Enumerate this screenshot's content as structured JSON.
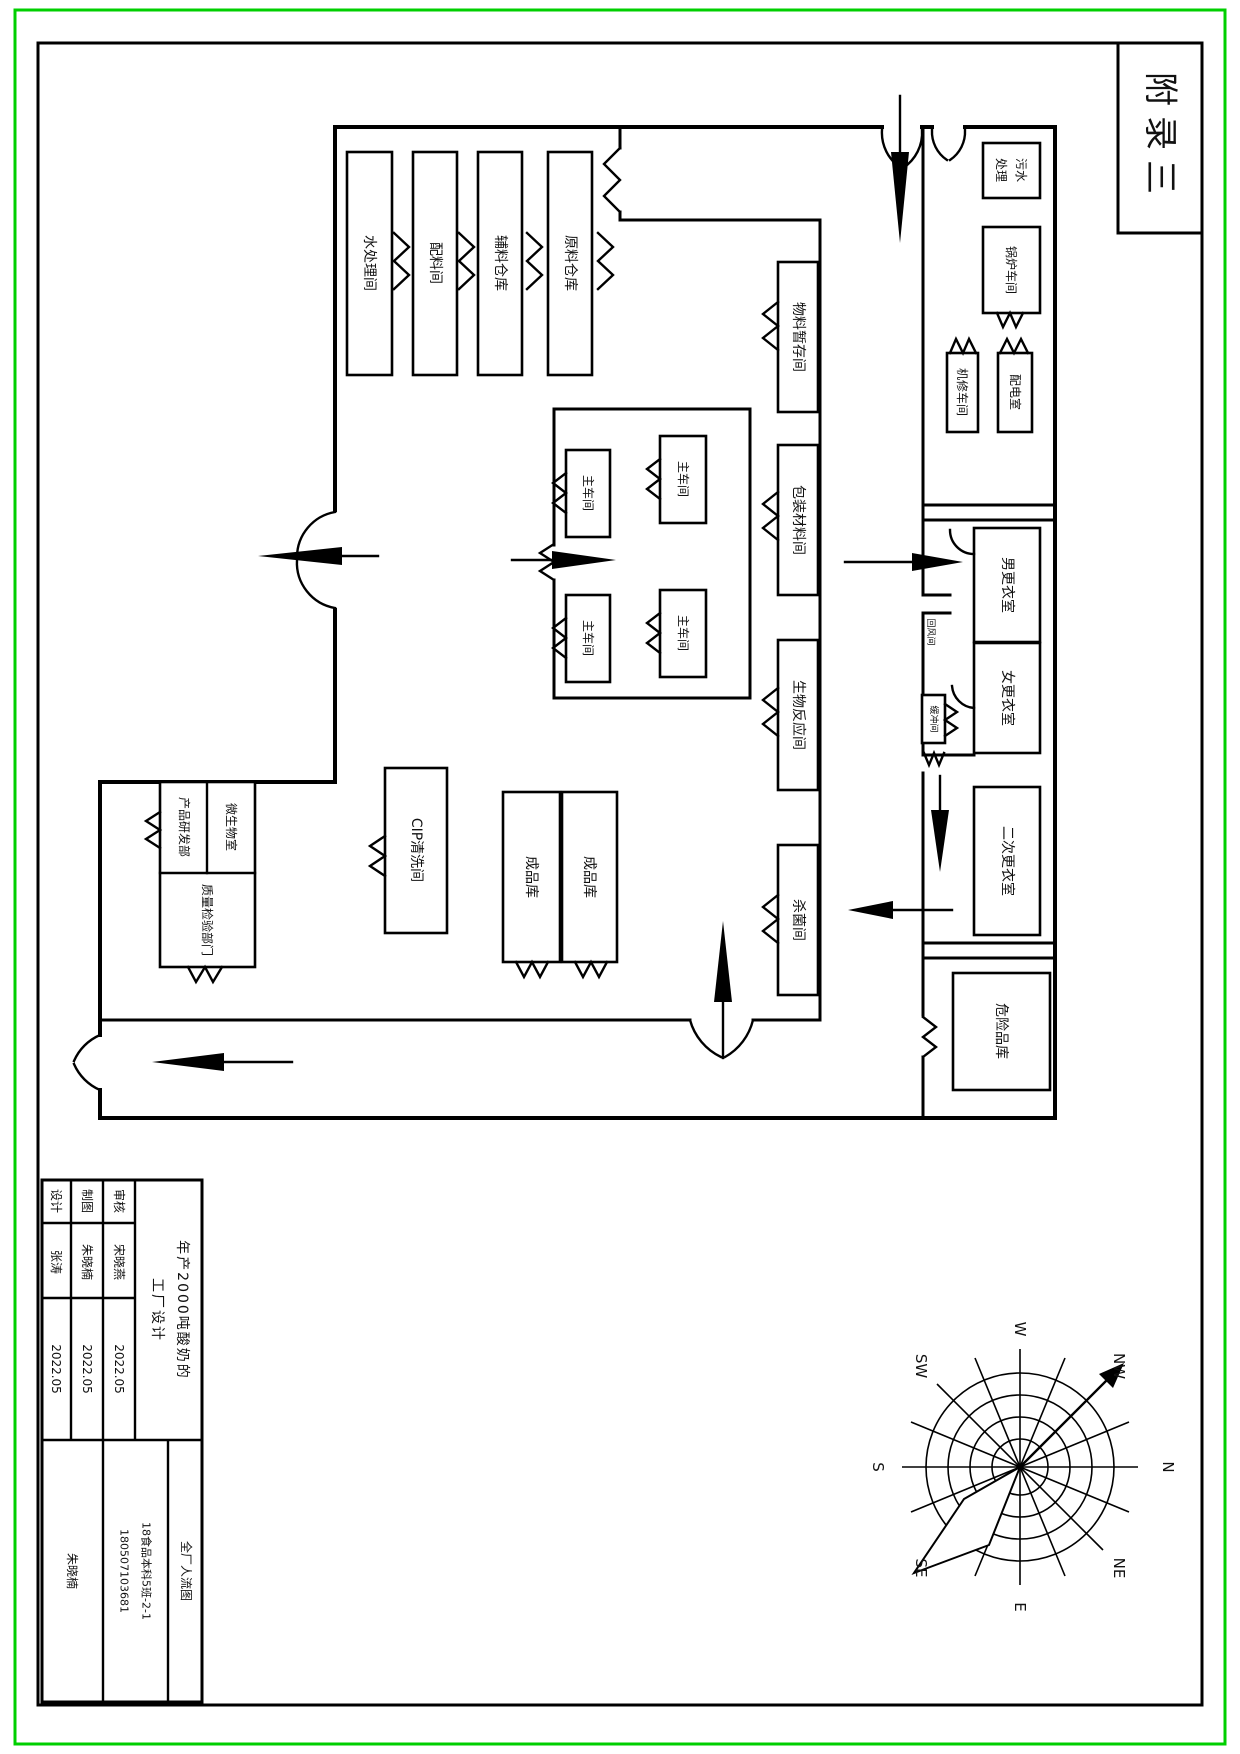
{
  "page": {
    "appendix_label": "附录三"
  },
  "rooms": {
    "water_treatment": "水处理间",
    "ingredient": "配料间",
    "aux_warehouse": "辅料仓库",
    "raw_warehouse": "原料仓库",
    "material_temp": "物料暂存间",
    "packaging": "包装材料间",
    "bio_reaction": "生物反应间",
    "sterilization": "杀菌间",
    "main_workshop": "主车间",
    "rnd": "产品研发部",
    "micro_lab": "微生物室",
    "qc": "质量检验部门",
    "cip": "CIP清洗间",
    "finished_goods": "成品库",
    "sewage_line1": "污水",
    "sewage_line2": "处理",
    "boiler": "锅炉车间",
    "machine_repair": "机修车间",
    "electrical": "配电室",
    "male_changing": "男更衣室",
    "female_changing": "女更衣室",
    "secondary_changing": "二次更衣室",
    "hazard_storage": "危险品库",
    "buffer": "缓冲间",
    "air_return": "回风间"
  },
  "title_block": {
    "rows": [
      {
        "label": "设计",
        "name": "张涛",
        "date": "2022.05"
      },
      {
        "label": "制图",
        "name": "朱晓楠",
        "date": "2022.05"
      },
      {
        "label": "审核",
        "name": "宋晓燕",
        "date": "2022.05"
      }
    ],
    "project_title_line1": "年产2000吨酸奶的",
    "project_title_line2": "工厂设计",
    "author": "朱晓楠",
    "class_info": "18食品本科5班-2-1",
    "student_id": "180507103681",
    "drawing_name": "全厂人流图"
  },
  "compass": {
    "n": "N",
    "ne": "NE",
    "e": "E",
    "se": "SE",
    "s": "S",
    "sw": "SW",
    "w": "W",
    "nw": "NW"
  }
}
